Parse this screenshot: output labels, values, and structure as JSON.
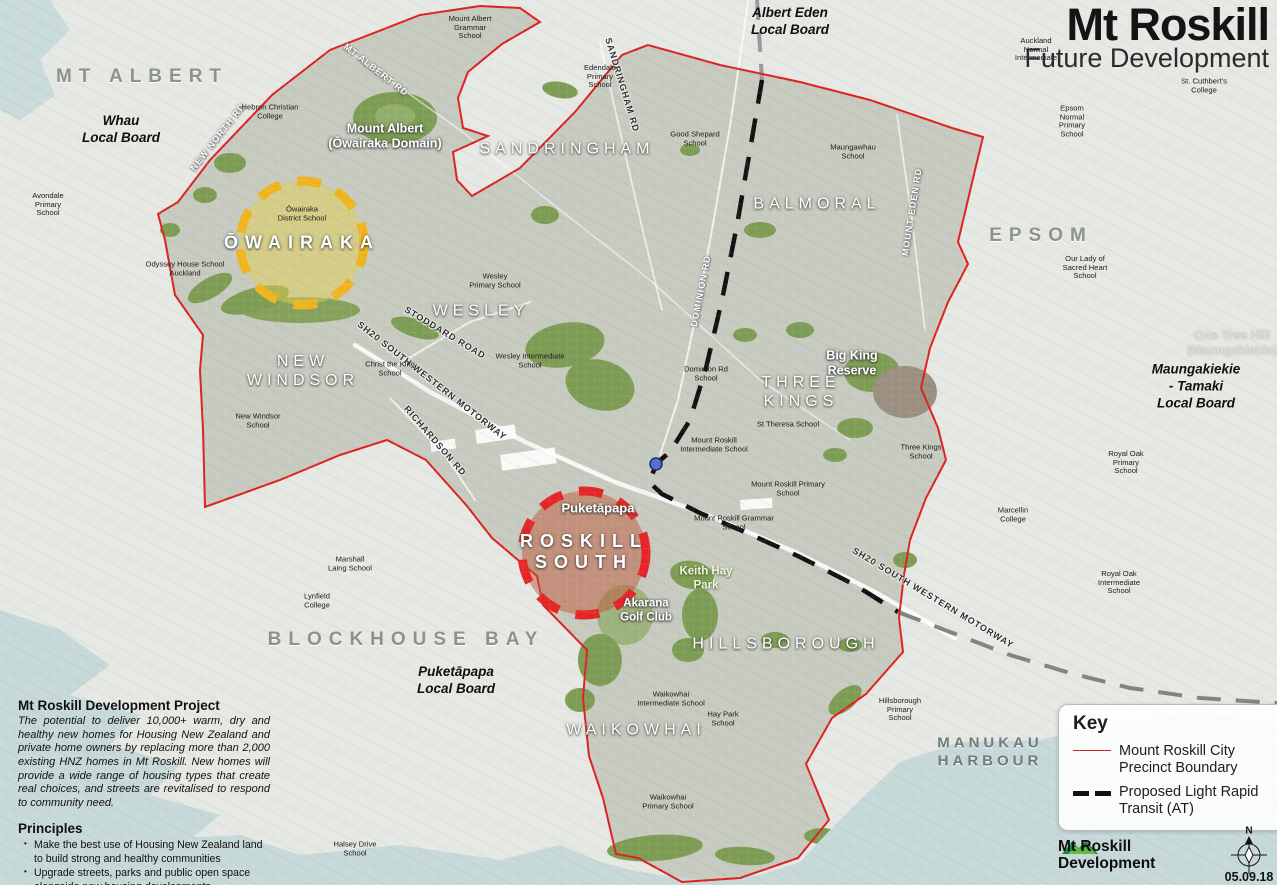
{
  "title": {
    "main": "Mt Roskill",
    "subtitle": "Future Development"
  },
  "key": {
    "heading": "Key",
    "items": [
      {
        "label": "Mount Roskill City Precinct Boundary",
        "symbol": "red-line",
        "color": "#c0272d"
      },
      {
        "label": "Proposed Light Rapid Transit (AT)",
        "symbol": "black-dashed-line",
        "color": "#111111"
      }
    ]
  },
  "project": {
    "heading": "Mt Roskill Development Project",
    "description": "The potential to deliver 10,000+ warm, dry and healthy new homes for Housing New Zealand and private home owners by replacing more than 2,000 existing HNZ homes in Mt Roskill. New homes will provide a wide range of housing types that create real choices, and streets are revitalised to respond to community need.",
    "principles_heading": "Principles",
    "principles": [
      "Make the best use of Housing New Zealand land to build strong and healthy communities",
      "Upgrade streets, parks and public open space alongside new housing developments",
      "Improve walking, cycling and public transport networks to give residents better transit options"
    ]
  },
  "footer": {
    "logo_line1": "Mt Roskill",
    "logo_line2": "Development",
    "date": "05.09.18",
    "compass_n": "N"
  },
  "map": {
    "colors": {
      "precinct_boundary": "#dd2020",
      "lrt_line": "#111111",
      "lrt_line_outside": "#8a8a8a",
      "owairaka_circle": "#f0b41e",
      "roskill_south_circle": "#e52528",
      "water": "#c6d9d8",
      "land_outside": "#e6e8e4",
      "land_inside": "#c6cabf",
      "park_green": "#7d9c54",
      "lrt_stop_marker": "#4a74c9"
    },
    "focus_areas": [
      {
        "name": "ŌWAIRAKA",
        "color": "#f0b41e"
      },
      {
        "name": "ROSKILL SOUTH",
        "color": "#e52528"
      }
    ],
    "markers": [
      {
        "name": "lrt-stop-marker",
        "color": "#4a74c9"
      }
    ],
    "labels": [
      {
        "name": "suburb-label-mt-albert",
        "text": "MT ALBERT",
        "type": "suburb_out",
        "x": 142,
        "y": 77
      },
      {
        "name": "suburb-label-epsom",
        "text": "EPSOM",
        "type": "suburb_out",
        "x": 1041,
        "y": 236
      },
      {
        "name": "suburb-label-blockhouse-bay",
        "text": "BLOCKHOUSE BAY",
        "type": "suburb_out",
        "x": 406,
        "y": 640
      },
      {
        "name": "water-label-manukau-harbour",
        "text": "MANUKAU\nHARBOUR",
        "type": "harbour",
        "x": 990,
        "y": 752
      },
      {
        "name": "suburb-label-sandringham",
        "text": "SANDRINGHAM",
        "type": "suburb",
        "x": 567,
        "y": 150
      },
      {
        "name": "suburb-label-balmoral",
        "text": "BALMORAL",
        "type": "suburb",
        "x": 817,
        "y": 205
      },
      {
        "name": "suburb-label-wesley",
        "text": "WESLEY",
        "type": "suburb",
        "x": 481,
        "y": 312
      },
      {
        "name": "suburb-label-new-windsor",
        "text": "NEW\nWINDSOR",
        "type": "suburb",
        "x": 303,
        "y": 372
      },
      {
        "name": "suburb-label-three-kings",
        "text": "THREE\nKINGS",
        "type": "suburb",
        "x": 801,
        "y": 393
      },
      {
        "name": "suburb-label-hillsborough",
        "text": "HILLSBOROUGH",
        "type": "suburb",
        "x": 786,
        "y": 645
      },
      {
        "name": "suburb-label-waikowhai",
        "text": "WAIKOWHAI",
        "type": "suburb",
        "x": 636,
        "y": 731
      },
      {
        "name": "suburb-label-owairaka",
        "text": "ŌWAIRAKA",
        "type": "suburb_big",
        "x": 302,
        "y": 243
      },
      {
        "name": "suburb-label-roskill-south",
        "text": "ROSKILL\nSOUTH",
        "type": "suburb_big",
        "x": 584,
        "y": 552
      },
      {
        "name": "board-label-albert-eden",
        "text": "Albert Eden\nLocal Board",
        "type": "board",
        "x": 790,
        "y": 22
      },
      {
        "name": "board-label-whau",
        "text": "Whau\nLocal Board",
        "type": "board",
        "x": 121,
        "y": 130
      },
      {
        "name": "board-label-puketapapa",
        "text": "Puketāpapa\nLocal Board",
        "type": "board",
        "x": 456,
        "y": 681
      },
      {
        "name": "board-label-maungakiekie-tamaki",
        "text": "Maungakiekie - Tamaki\nLocal Board",
        "type": "board",
        "x": 1196,
        "y": 387
      },
      {
        "name": "place-label-mount-albert-domain",
        "text": "Mount Albert\n(Ōwairaka Domain)",
        "type": "place",
        "x": 385,
        "y": 136
      },
      {
        "name": "place-label-big-king-reserve",
        "text": "Big King\nReserve",
        "type": "place",
        "x": 852,
        "y": 363
      },
      {
        "name": "place-label-puketapapa",
        "text": "Puketāpapa",
        "type": "place",
        "x": 598,
        "y": 508,
        "size": 13
      },
      {
        "name": "place-label-one-tree-hill",
        "text": "One Tree Hill\n(Maungakiekie)",
        "type": "place_faint",
        "x": 1232,
        "y": 343
      },
      {
        "name": "park-label-keith-hay-park",
        "text": "Keith Hay\nPark",
        "type": "park",
        "x": 706,
        "y": 579
      },
      {
        "name": "place-label-akarana-golf-club",
        "text": "Akarana\nGolf Club",
        "type": "place",
        "x": 646,
        "y": 611,
        "size": 11.5
      },
      {
        "name": "road-label-new-north-rd",
        "text": "NEW NORTH RD",
        "type": "road_white",
        "x": 218,
        "y": 137,
        "rot": -52
      },
      {
        "name": "road-label-mt-albert-rd",
        "text": "MT ALBERT RD",
        "type": "road_white",
        "x": 376,
        "y": 70,
        "rot": 38
      },
      {
        "name": "road-label-sandringham-rd",
        "text": "SANDRINGHAM RD",
        "type": "road_dark",
        "x": 622,
        "y": 85,
        "rot": 73
      },
      {
        "name": "road-label-dominion-rd",
        "text": "DOMINION RD",
        "type": "road_white",
        "x": 701,
        "y": 291,
        "rot": -79
      },
      {
        "name": "road-label-mount-eden-rd",
        "text": "MOUNT EDEN RD",
        "type": "road_white",
        "x": 912,
        "y": 212,
        "rot": -81
      },
      {
        "name": "road-label-stoddard-road",
        "text": "STODDARD ROAD",
        "type": "road_dark",
        "x": 445,
        "y": 333,
        "rot": 31
      },
      {
        "name": "road-label-sh20-motorway-nw",
        "text": "SH20 SOUTH WESTERN MOTORWAY",
        "type": "road_dark",
        "x": 432,
        "y": 381,
        "rot": 38
      },
      {
        "name": "road-label-richardson-rd",
        "text": "RICHARDSON RD",
        "type": "road_dark",
        "x": 435,
        "y": 441,
        "rot": 49
      },
      {
        "name": "road-label-sh20-motorway-se",
        "text": "SH20 SOUTH WESTERN MOTORWAY",
        "type": "road_dark",
        "x": 933,
        "y": 598,
        "rot": 31
      },
      {
        "name": "school-label-avondale-primary",
        "text": "Avondale\nPrimary\nSchool",
        "type": "school",
        "x": 48,
        "y": 205
      },
      {
        "name": "school-label-hebron-christian-college",
        "text": "Hebron Christian\nCollege",
        "type": "school",
        "x": 270,
        "y": 112
      },
      {
        "name": "school-label-mount-albert-grammar",
        "text": "Mount Albert\nGrammar\nSchool",
        "type": "school",
        "x": 470,
        "y": 28
      },
      {
        "name": "school-label-edendale-primary",
        "text": "Edendale\nPrimary\nSchool",
        "type": "school",
        "x": 600,
        "y": 77
      },
      {
        "name": "school-label-good-shepard",
        "text": "Good Shepard\nSchool",
        "type": "school",
        "x": 695,
        "y": 139
      },
      {
        "name": "school-label-maungawhau",
        "text": "Maungawhau\nSchool",
        "type": "school",
        "x": 853,
        "y": 152
      },
      {
        "name": "school-label-auckland-normal-intermediate",
        "text": "Auckland\nNormal\nIntermediate",
        "type": "school",
        "x": 1036,
        "y": 50
      },
      {
        "name": "school-label-st-cuthberts-college",
        "text": "St. Cuthbert's\nCollege",
        "type": "school",
        "x": 1204,
        "y": 86
      },
      {
        "name": "school-label-epsom-normal-primary",
        "text": "Epsom\nNormal\nPrimary\nSchool",
        "type": "school",
        "x": 1072,
        "y": 122
      },
      {
        "name": "school-label-our-lady-sacred-heart",
        "text": "Our Lady of\nSacred Heart\nSchool",
        "type": "school",
        "x": 1085,
        "y": 268
      },
      {
        "name": "school-label-owairaka-district",
        "text": "Ōwairaka\nDistrict School",
        "type": "school",
        "x": 302,
        "y": 214
      },
      {
        "name": "school-label-odyssey-house",
        "text": "Odyssey House School\nAuckland",
        "type": "school",
        "x": 185,
        "y": 269
      },
      {
        "name": "school-label-wesley-primary",
        "text": "Wesley\nPrimary School",
        "type": "school",
        "x": 495,
        "y": 281
      },
      {
        "name": "school-label-wesley-intermediate",
        "text": "Wesley Intermediate\nSchool",
        "type": "school",
        "x": 530,
        "y": 361
      },
      {
        "name": "school-label-christ-the-king",
        "text": "Christ the King\nSchool",
        "type": "school",
        "x": 390,
        "y": 369
      },
      {
        "name": "school-label-new-windsor",
        "text": "New Windsor\nSchool",
        "type": "school",
        "x": 258,
        "y": 421
      },
      {
        "name": "school-label-dominion-rd",
        "text": "Dominion Rd\nSchool",
        "type": "school",
        "x": 706,
        "y": 374
      },
      {
        "name": "school-label-st-theresa",
        "text": "St Theresa School",
        "type": "school",
        "x": 788,
        "y": 425
      },
      {
        "name": "school-label-mount-roskill-intermediate",
        "text": "Mount Roskill\nIntermediate School",
        "type": "school",
        "x": 714,
        "y": 445
      },
      {
        "name": "school-label-mount-roskill-primary",
        "text": "Mount Roskill Primary\nSchool",
        "type": "school",
        "x": 788,
        "y": 489
      },
      {
        "name": "school-label-mount-roskill-grammar",
        "text": "Mount Roskill Grammar\nSchool",
        "type": "school",
        "x": 734,
        "y": 523
      },
      {
        "name": "school-label-three-kings",
        "text": "Three Kings\nSchool",
        "type": "school",
        "x": 921,
        "y": 452
      },
      {
        "name": "school-label-marshall-laing",
        "text": "Marshall\nLaing School",
        "type": "school",
        "x": 350,
        "y": 564
      },
      {
        "name": "school-label-lynfield-college",
        "text": "Lynfield\nCollege",
        "type": "school",
        "x": 317,
        "y": 601
      },
      {
        "name": "school-label-waikowhai-intermediate",
        "text": "Waikowhai\nIntermediate School",
        "type": "school",
        "x": 671,
        "y": 699
      },
      {
        "name": "school-label-hay-park",
        "text": "Hay Park\nSchool",
        "type": "school",
        "x": 723,
        "y": 719
      },
      {
        "name": "school-label-waikowhai-primary",
        "text": "Waikowhai\nPrimary School",
        "type": "school",
        "x": 668,
        "y": 802
      },
      {
        "name": "school-label-hillsborough-primary",
        "text": "Hillsborough\nPrimary\nSchool",
        "type": "school",
        "x": 900,
        "y": 710
      },
      {
        "name": "school-label-marcellin-college",
        "text": "Marcellin\nCollege",
        "type": "school",
        "x": 1013,
        "y": 515
      },
      {
        "name": "school-label-royal-oak-primary",
        "text": "Royal Oak\nPrimary\nSchool",
        "type": "school",
        "x": 1126,
        "y": 463
      },
      {
        "name": "school-label-royal-oak-intermediate",
        "text": "Royal Oak\nIntermediate\nSchool",
        "type": "school",
        "x": 1119,
        "y": 583
      },
      {
        "name": "school-label-halsey-drive",
        "text": "Halsey Drive\nSchool",
        "type": "school",
        "x": 355,
        "y": 849
      }
    ]
  }
}
